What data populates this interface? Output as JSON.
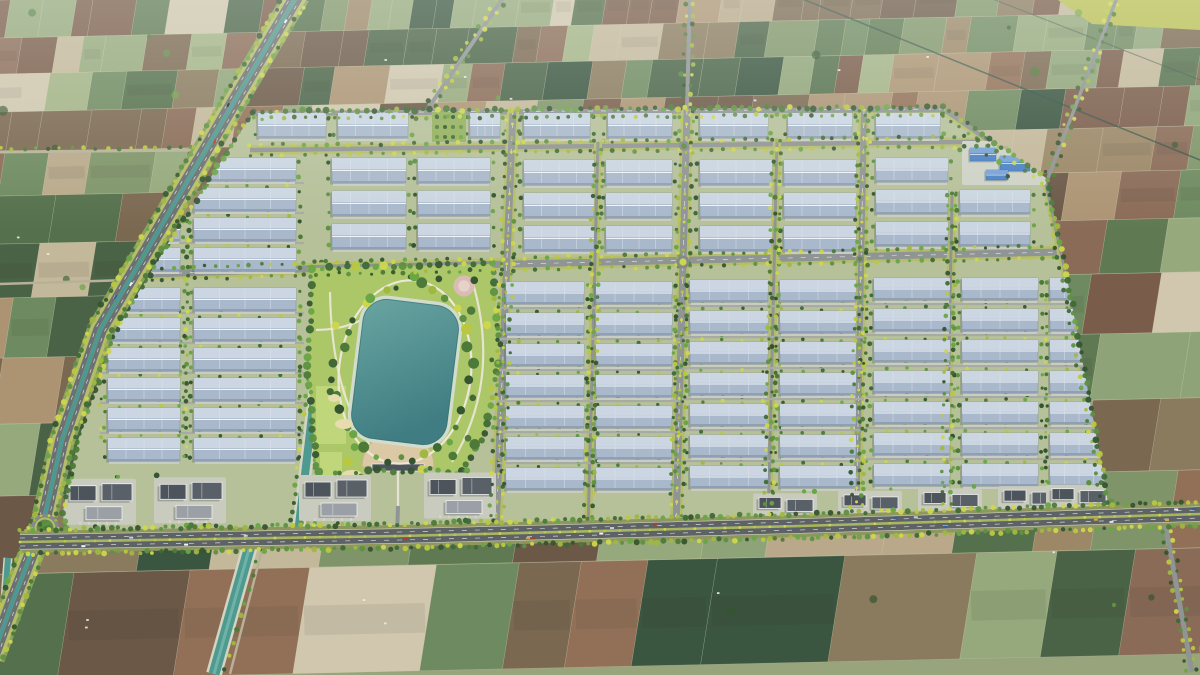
{
  "meta": {
    "type": "aerial-3d-render",
    "subject": "industrial-park-master-plan-surrounded-by-farmland",
    "view": "oblique-birds-eye"
  },
  "canvas": {
    "w": 1200,
    "h": 675,
    "seed": 20240711
  },
  "palette": {
    "bg": "#97a47c",
    "fieldPalette": [
      "#7f9569",
      "#8ea478",
      "#a2b385",
      "#5f7a53",
      "#4a6347",
      "#3a5540",
      "#95a97c",
      "#8a7a5e",
      "#9c8767",
      "#ac9473",
      "#7b6851",
      "#6b5847",
      "#b9a98a",
      "#c4b89b",
      "#8a6b57",
      "#7a5c4a",
      "#927057",
      "#d0c7ae",
      "#6e8a60",
      "#55704c"
    ],
    "fieldLine": "#ddd7bc",
    "treeGreens": [
      "#34552f",
      "#3f6a35",
      "#4d7a38",
      "#5d9141",
      "#6aa546"
    ],
    "treeYellows": [
      "#cdd74b",
      "#b9c840",
      "#9fb83f"
    ],
    "roadGray": "#8f9494",
    "roadDark": "#5d6266",
    "roadMinor": "#a6aba4",
    "laneDash": "#e9ebe9",
    "trackTan": "#b8b198",
    "vergeYellow": "#b6bd6a",
    "medianCanal": "#4e9894",
    "roadBase": "#8f975f",
    "blvdBase": "#8aa05e",
    "parkGround": "#b6c19a",
    "roofBase": "#a9b8cb",
    "roofLight": "#cbd6e2",
    "roofRidge": "#f0f4f8",
    "roofShade": "#8fa0b4",
    "roofEdge": "#7e90a6",
    "roofSeam": "#dde5ee",
    "apron": "#c9ccc3",
    "lakeHi": "#6aa5a2",
    "lakeLo": "#3f7d82",
    "lakeEdge": "#2f6a70",
    "shore": "#d2dccd",
    "lawn": "#abc768",
    "lawnLight": "#c6da7e",
    "plazaTan": "#dac9a4",
    "plazaEdge": "#c4b48e",
    "bunker": "#e6dcae",
    "pinkPlaza": "#d9bdb4",
    "pinkInner": "#e6d2c9",
    "officeDark": "#4e545b",
    "officeDark2": "#5a6068",
    "officeLight": "#9aa0a6",
    "officeWhite": "#eef0f2",
    "officePad": "#c8cbbd",
    "utilBlue": "#4d82c4",
    "utilBlueHi": "#78a2d6",
    "utilPad": "#cfd2c6",
    "canalTeal": "#4f9a90",
    "canalBank": "#d3d5c2",
    "carColors": [
      "#f4f4f4",
      "#dfe3e6",
      "#23282e",
      "#b23a2e",
      "#2f5ea6",
      "#c8ced4",
      "#e0a62f"
    ],
    "shadow": "#55614f",
    "darkLine": "#2f4f45",
    "haze": "#f0f4ef"
  },
  "fields": {
    "bands": [
      0,
      38,
      74,
      112,
      152,
      196,
      244,
      298,
      358,
      424,
      496,
      574,
      680
    ],
    "slope": -0.022,
    "lean": 0.16,
    "wMinTopBottom": [
      16,
      70
    ],
    "wMaxTopBottom": [
      44,
      150
    ],
    "hatchChance": 0.3
  },
  "cornerField": {
    "poly": [
      [
        1058,
        0
      ],
      [
        1200,
        0
      ],
      [
        1200,
        30
      ],
      [
        1092,
        24
      ]
    ],
    "color": "#b9c050"
  },
  "diagLines": [
    {
      "pts": [
        [
          795,
          -4
        ],
        [
          1200,
          160
        ]
      ],
      "w": 1.6,
      "opacity": 0.7
    },
    {
      "pts": [
        [
          985,
          -4
        ],
        [
          1200,
          80
        ]
      ],
      "w": 1.2,
      "opacity": 0.5
    }
  ],
  "farmTracks": [
    {
      "pts": [
        [
          0,
          152
        ],
        [
          206,
          150
        ]
      ],
      "w": 3,
      "trees": true
    },
    {
      "pts": [
        [
          0,
          284
        ],
        [
          129,
          280
        ]
      ],
      "w": 2.5,
      "trees": false
    }
  ],
  "accessRoads": [
    {
      "pts": [
        [
          690,
          -5
        ],
        [
          687,
          108
        ]
      ],
      "w": 4
    },
    {
      "pts": [
        [
          505,
          -5
        ],
        [
          427,
          110
        ]
      ],
      "w": 4
    },
    {
      "pts": [
        [
          1118,
          -5
        ],
        [
          1048,
          178
        ]
      ],
      "w": 3.5
    },
    {
      "pts": [
        [
          1165,
          522
        ],
        [
          1192,
          672
        ]
      ],
      "w": 5
    }
  ],
  "southCanal": {
    "water": [
      [
        250,
        546
      ],
      [
        214,
        674
      ]
    ],
    "road": [
      [
        263,
        546
      ],
      [
        230,
        674
      ]
    ]
  },
  "westCanal": {
    "pts": [
      [
        8,
        558
      ],
      [
        2,
        642
      ]
    ],
    "w": 7
  },
  "park": {
    "polygon": [
      [
        254,
        111
      ],
      [
        944,
        107
      ],
      [
        1046,
        178
      ],
      [
        1064,
        262
      ],
      [
        1104,
        478
      ],
      [
        1110,
        517
      ],
      [
        560,
        530
      ],
      [
        70,
        536
      ],
      [
        62,
        515
      ],
      [
        78,
        440
      ],
      [
        116,
        330
      ],
      [
        170,
        240
      ]
    ]
  },
  "boulevard": {
    "pts": [
      [
        298,
        -6
      ],
      [
        235,
        100
      ],
      [
        150,
        245
      ],
      [
        100,
        330
      ],
      [
        62,
        440
      ],
      [
        45,
        515
      ]
    ],
    "ext": [
      [
        45,
        518
      ],
      [
        14,
        598
      ],
      [
        -8,
        658
      ]
    ]
  },
  "bottomRoad": {
    "pts": [
      [
        20,
        542
      ],
      [
        400,
        536
      ],
      [
        800,
        526
      ],
      [
        1200,
        514
      ]
    ]
  },
  "bigRoundabout": {
    "x": 45,
    "y": 528,
    "r": 14
  },
  "roundabouts": [
    {
      "x": 684,
      "y": 146,
      "r": 5,
      "inner": "green"
    },
    {
      "x": 683,
      "y": 262,
      "r": 6.5,
      "inner": "yellow"
    },
    {
      "x": 860,
      "y": 259,
      "r": 4,
      "inner": "green"
    }
  ],
  "streets": [
    {
      "pts": [
        [
          250,
          113
        ],
        [
          944,
          109
        ]
      ],
      "w": 6,
      "dash": true
    },
    {
      "pts": [
        [
          250,
          150
        ],
        [
          1045,
          141
        ]
      ],
      "w": 4.5,
      "dash": false
    },
    {
      "pts": [
        [
          151,
          274
        ],
        [
          330,
          268
        ],
        [
          1063,
          252
        ]
      ],
      "w": 7,
      "dash": true
    },
    {
      "pts": [
        [
          513,
          110
        ],
        [
          496,
          529
        ]
      ],
      "w": 7,
      "dash": true,
      "median": true
    },
    {
      "pts": [
        [
          687,
          110
        ],
        [
          676,
          529
        ]
      ],
      "w": 7,
      "dash": true,
      "median": true
    },
    {
      "pts": [
        [
          864,
          110
        ],
        [
          856,
          529
        ]
      ],
      "w": 6,
      "dash": true,
      "median": true
    },
    {
      "pts": [
        [
          945,
          110
        ],
        [
          1046,
          180
        ],
        [
          1064,
          262
        ],
        [
          1102,
          476
        ],
        [
          1107,
          514
        ]
      ],
      "w": 5,
      "dash": false
    },
    {
      "pts": [
        [
          598,
          142
        ],
        [
          588,
          529
        ]
      ],
      "w": 3,
      "dash": false
    },
    {
      "pts": [
        [
          777,
          141
        ],
        [
          768,
          529
        ]
      ],
      "w": 3,
      "dash": false
    },
    {
      "pts": [
        [
          952,
          196
        ],
        [
          946,
          518
        ]
      ],
      "w": 3,
      "dash": false
    }
  ],
  "treeStrips": [
    {
      "pts": [
        [
          189,
          158
        ],
        [
          185,
          462
        ]
      ]
    }
  ],
  "canalInPark": {
    "pts": [
      [
        330,
        263
      ],
      [
        302,
        500
      ],
      [
        298,
        533
      ]
    ]
  },
  "blocks": [
    {
      "n": "top-row",
      "h": 25,
      "rows": [
        113
      ],
      "cols": [
        [
          258,
          326
        ],
        [
          338,
          408
        ],
        [
          470,
          500
        ],
        [
          524,
          590
        ],
        [
          608,
          672
        ],
        [
          700,
          768
        ],
        [
          788,
          852
        ],
        [
          876,
          940
        ]
      ]
    },
    {
      "n": "west-upper",
      "h": 23,
      "rows": [
        158,
        188,
        218,
        248
      ],
      "cols": [
        [
          116,
          180
        ],
        [
          194,
          296
        ]
      ]
    },
    {
      "n": "west-lower",
      "h": 23,
      "rows": [
        288,
        318,
        348,
        378,
        408,
        438
      ],
      "cols": [
        [
          108,
          180
        ],
        [
          194,
          296
        ]
      ]
    },
    {
      "n": "north-of-park",
      "h": 25,
      "rows": [
        158,
        191,
        224
      ],
      "cols": [
        [
          332,
          406
        ],
        [
          418,
          490
        ]
      ]
    },
    {
      "n": "mid-upper",
      "h": 25,
      "rows": [
        160,
        193,
        226
      ],
      "cols": [
        [
          524,
          594
        ],
        [
          606,
          672
        ]
      ]
    },
    {
      "n": "east-upper-1",
      "h": 25,
      "rows": [
        160,
        193,
        226
      ],
      "cols": [
        [
          700,
          772
        ],
        [
          784,
          856
        ]
      ]
    },
    {
      "n": "east-upper-2",
      "h": 24,
      "rows": [
        158,
        190,
        222
      ],
      "cols": [
        [
          876,
          948
        ],
        [
          960,
          1030
        ]
      ],
      "skipNE": true
    },
    {
      "n": "mid-lower",
      "h": 22,
      "rows": [
        282,
        313,
        344,
        375,
        406,
        437,
        468
      ],
      "cols": [
        [
          506,
          584
        ],
        [
          596,
          672
        ]
      ]
    },
    {
      "n": "east-lower-1",
      "h": 22,
      "rows": [
        280,
        311,
        342,
        373,
        404,
        435,
        466
      ],
      "cols": [
        [
          690,
          768
        ],
        [
          780,
          856
        ]
      ]
    },
    {
      "n": "east-lower-2",
      "h": 22,
      "rows": [
        278,
        309,
        340,
        371,
        402,
        433,
        464
      ],
      "cols": [
        [
          874,
          950
        ],
        [
          962,
          1038
        ],
        [
          1050,
          1108
        ]
      ]
    }
  ],
  "utility": {
    "pad": [
      962,
      141,
      84,
      44
    ],
    "buildings": [
      [
        970,
        148,
        26,
        13
      ],
      [
        1000,
        156,
        30,
        15
      ],
      [
        986,
        170,
        22,
        10
      ]
    ],
    "white": [
      [
        1024,
        146,
        14,
        8
      ]
    ]
  },
  "offices": {
    "left": {
      "clusters": [
        100,
        190,
        335,
        460
      ],
      "padW": 72,
      "padH": 46,
      "rise": 62
    },
    "right": {
      "clusters": [
        785,
        870,
        950,
        1030,
        1078
      ],
      "padW": 64,
      "padH": 28,
      "rise": 33
    }
  },
  "centralPark": {
    "lawnPoly": [
      [
        312,
        268
      ],
      [
        492,
        264
      ],
      [
        500,
        345
      ],
      [
        486,
        432
      ],
      [
        460,
        476
      ],
      [
        430,
        468
      ],
      [
        398,
        472
      ],
      [
        366,
        470
      ],
      [
        336,
        498
      ],
      [
        316,
        466
      ],
      [
        308,
        372
      ]
    ],
    "lake": {
      "cx": 405,
      "cy": 372,
      "w": 100,
      "h": 144,
      "rot": 7,
      "rx": 26
    },
    "ringRx": 66,
    "ringRy": 92,
    "pink": {
      "cx": 464,
      "cy": 286,
      "r": 10.5
    },
    "bunkers": [
      [
        344,
        424,
        9,
        5
      ],
      [
        352,
        476,
        11,
        6
      ],
      [
        334,
        398,
        6,
        4
      ]
    ],
    "plaza": {
      "cx": 398,
      "cy": 467,
      "r": 36
    },
    "gate": {
      "x": 372,
      "y": 464,
      "w": 52,
      "h": 7
    },
    "orchard": {
      "x": 432,
      "y": 112,
      "w": 34,
      "h": 30
    },
    "stripes": [
      [
        316,
        386,
        30,
        58
      ],
      [
        320,
        452,
        22,
        30
      ]
    ],
    "paths": [
      "M330,292 Q332,420 392,468",
      "M472,280 Q502,380 452,462",
      "M398,462 L398,506",
      "M316,330 Q360,330 388,300"
    ],
    "gateAccess": [
      [
        398,
        506
      ],
      [
        397,
        537
      ]
    ]
  },
  "cars": {
    "bottomCount": 18,
    "bottomLanes": [
      -5.2,
      -2.6,
      2.6,
      5.2
    ],
    "blvdCount": 5,
    "blvdLanes": [
      -3.4,
      3.4
    ]
  },
  "scatter": {
    "houses": 26,
    "treeBlobs": 42
  },
  "haze": {
    "toY": 230,
    "opacity": 0.3
  }
}
